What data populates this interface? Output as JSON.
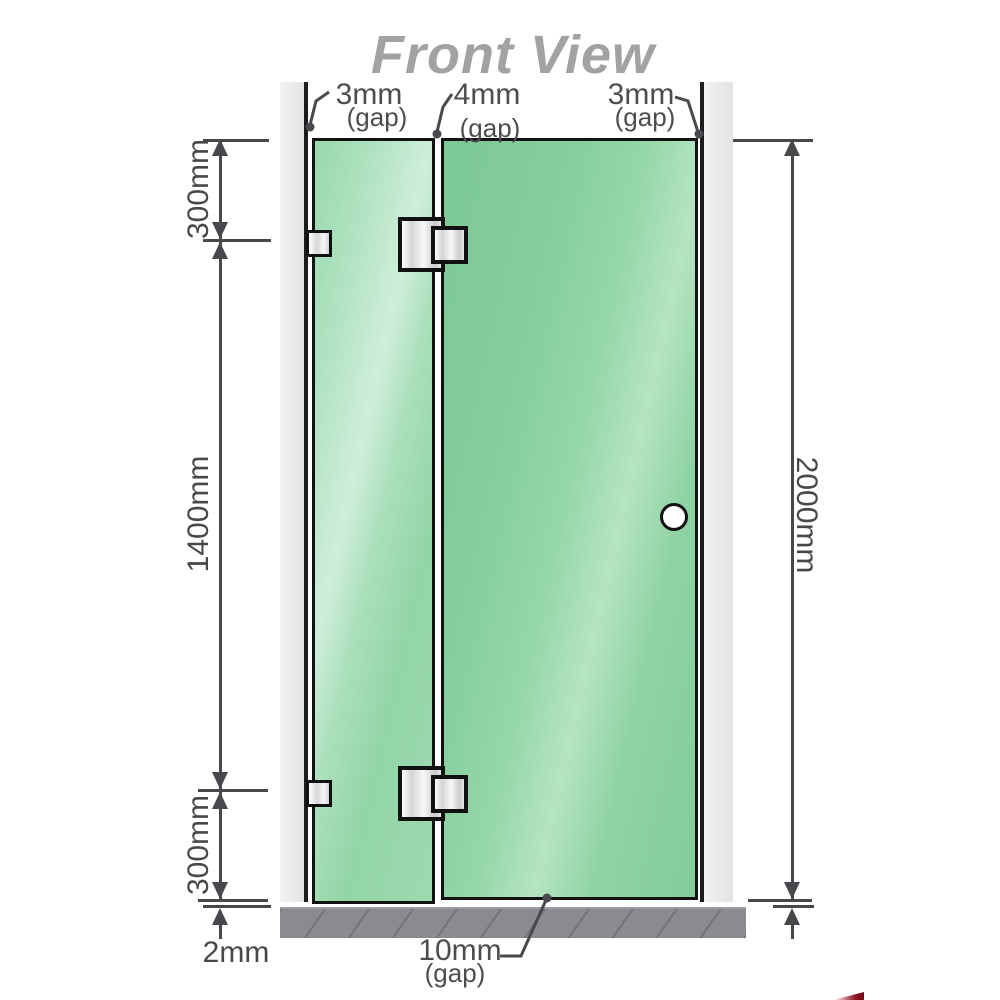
{
  "title": "Front View",
  "gap_labels": {
    "top": [
      {
        "value": "3mm",
        "suffix": "(gap)"
      },
      {
        "value": "4mm",
        "suffix": "(gap)"
      },
      {
        "value": "3mm",
        "suffix": "(gap)"
      }
    ],
    "bottom": {
      "value": "10mm",
      "suffix": "(gap)"
    }
  },
  "dimensions": {
    "left_top": "300mm",
    "left_middle": "1400mm",
    "left_bottom": "300mm",
    "floor_gap": "2mm",
    "right_total": "2000mm"
  },
  "colors": {
    "glass_green": "#8fd3a3",
    "glass_highlight": "#cfeeda",
    "wall_gray": "#e9e9eb",
    "base_gray": "#8b8b8f",
    "outline_black": "#111111",
    "dimension_gray": "#48484c",
    "title_gray": "#a2a2a2",
    "hardware_silver": "#d8dadc",
    "logo_red": "#8f1322"
  }
}
